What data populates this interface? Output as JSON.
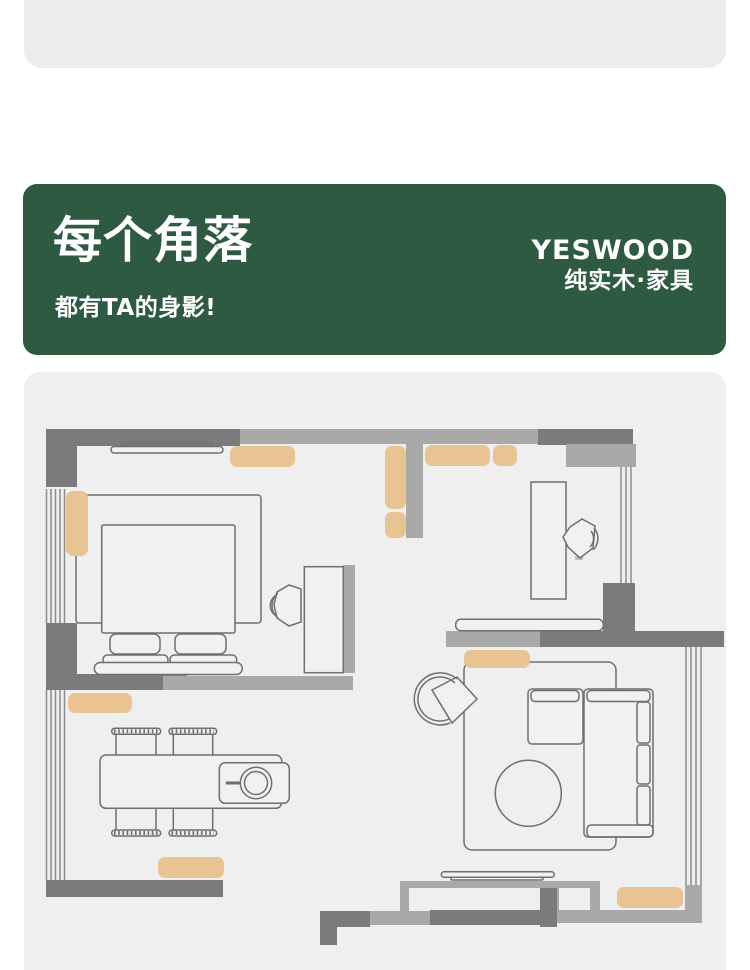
{
  "banner": {
    "title": "每个角落",
    "subtitle": "都有TA的身影!",
    "brand": "YESWOOD",
    "brand_tagline": "纯实木·家具"
  },
  "colors": {
    "page-bg": "#ffffff",
    "top-panel-bg": "#ececec",
    "banner-green": "#2e5a42",
    "banner-text": "#ffffff",
    "panel-bg": "#efefef",
    "wall-dark": "#7b7b7b",
    "wall-medium": "#a9a9a9",
    "window-line": "#8c8c8c",
    "outline": "#6f6f6f",
    "furniture-fill": "#f1f1f1",
    "highlight-tan": "#e8c492"
  },
  "floorplan": {
    "type": "apartment-floor-plan",
    "highlight_count": 10,
    "rooms": [
      {
        "name": "bedroom",
        "items": [
          "double-bed",
          "pillows",
          "area-rug",
          "curtain-shelf",
          "tv-desk",
          "chair",
          "highlight-shelf-top",
          "highlight-cabinet-left"
        ]
      },
      {
        "name": "study",
        "items": [
          "desk",
          "chair",
          "window",
          "highlight-shelf-long",
          "highlight-shelf-short",
          "highlight-hall-cabinet-tall",
          "highlight-hall-cabinet-small"
        ]
      },
      {
        "name": "dining-room",
        "items": [
          "dining-table",
          "four-chairs",
          "highchair",
          "window",
          "highlight-sideboard-top",
          "highlight-sideboard-bottom"
        ]
      },
      {
        "name": "living-room",
        "items": [
          "l-shaped-sofa",
          "armchair",
          "area-rug",
          "round-rug",
          "console-table",
          "tv-media-wall",
          "window",
          "highlight-cabinet-top",
          "highlight-cabinet-bottom"
        ]
      }
    ]
  }
}
